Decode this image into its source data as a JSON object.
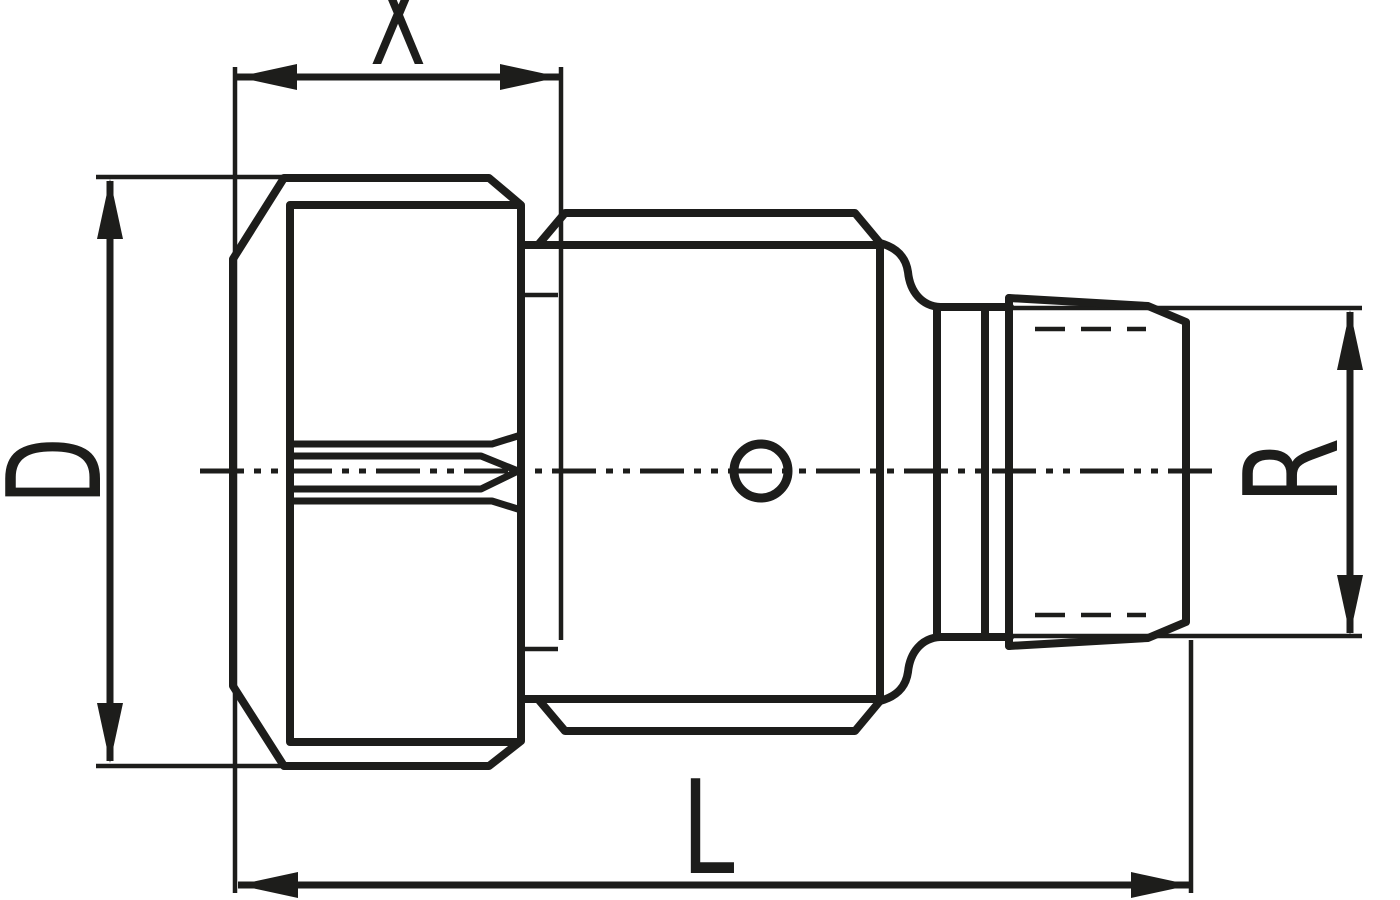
{
  "labels": {
    "x": "X",
    "d": "D",
    "l": "L",
    "r": "R"
  },
  "colors": {
    "line": "#1d1d1b",
    "background": "#ffffff"
  }
}
